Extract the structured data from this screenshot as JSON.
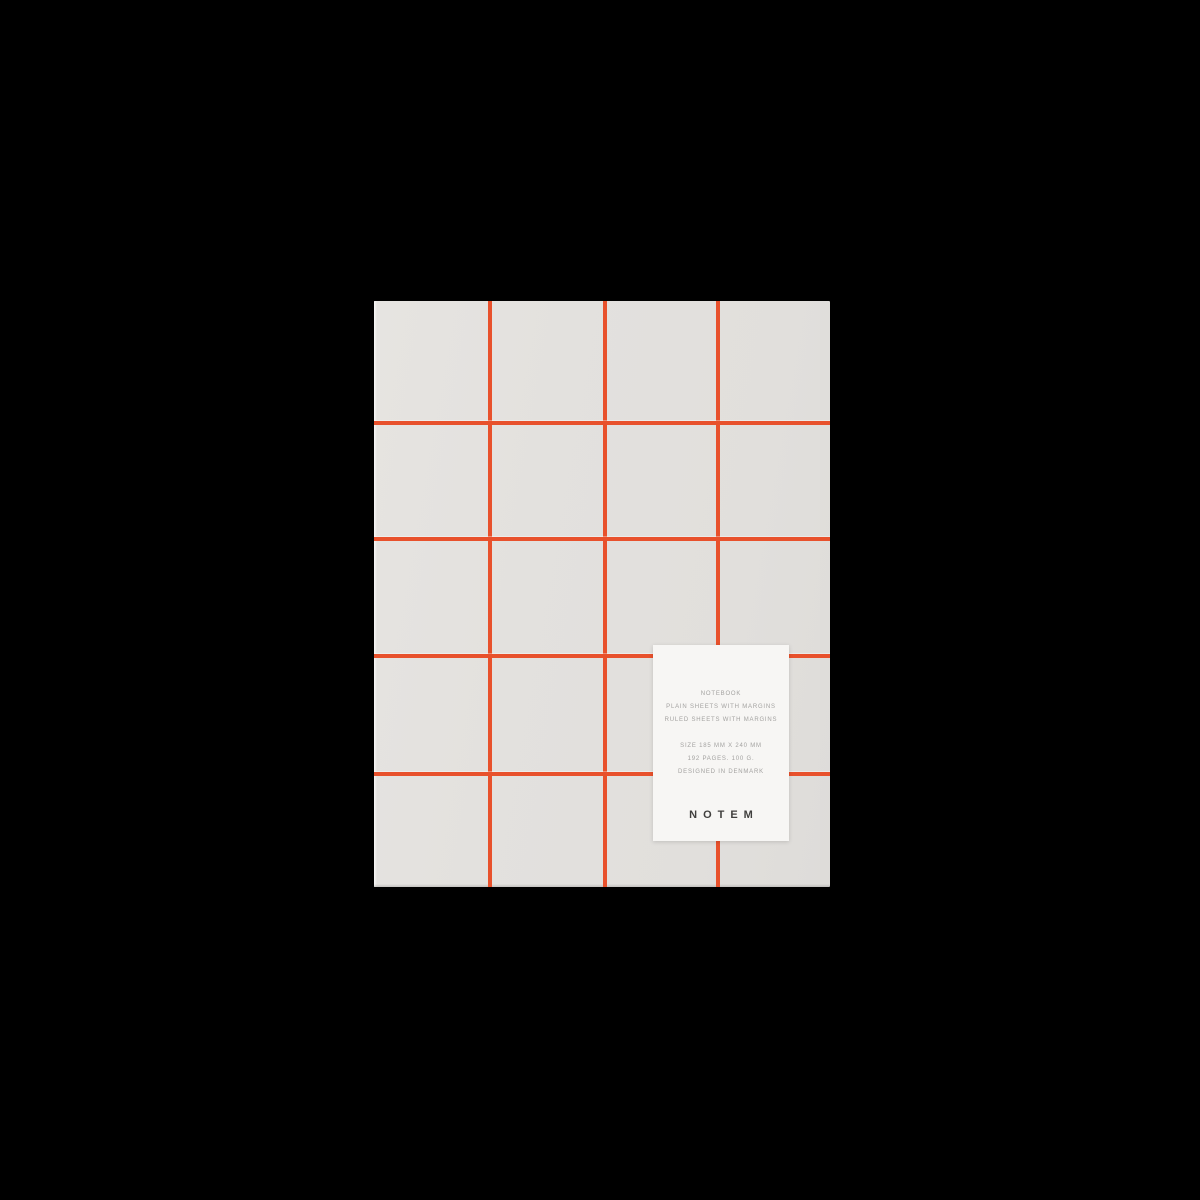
{
  "product": {
    "brand": "NOTEM",
    "label": {
      "lines": [
        "NOTEBOOK",
        "PLAIN SHEETS WITH MARGINS",
        "RULED SHEETS WITH MARGINS"
      ],
      "specs": [
        "SIZE 185 MM X 240 MM",
        "192 PAGES. 100 G.",
        "DESIGNED IN DENMARK"
      ],
      "wordmark": "NOTEM"
    },
    "colors": {
      "background": "#000000",
      "cover": "#e3e1de",
      "grid_line": "#e8512c",
      "label_background": "#f7f6f4",
      "label_text": "#a3a2a0",
      "wordmark_text": "#403f3d"
    }
  }
}
